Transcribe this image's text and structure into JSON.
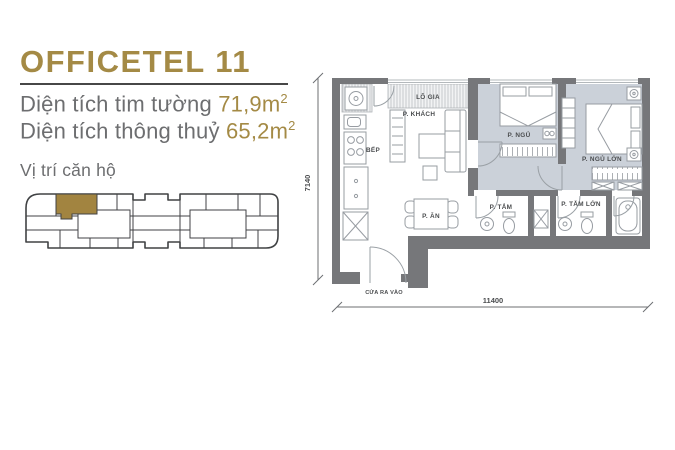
{
  "unit": {
    "title": "OFFICETEL 11",
    "areas": [
      {
        "label": "Diện tích tim tường ",
        "value": "71,9m",
        "sup": "2"
      },
      {
        "label": "Diện tích thông thuỷ ",
        "value": "65,2m",
        "sup": "2"
      }
    ],
    "location_label": "Vị trí căn hộ"
  },
  "floor_plan": {
    "rooms": {
      "loggia": "LÔ GIA",
      "living": "P. KHÁCH",
      "kitchen": "BẾP",
      "bedroom": "P. NGỦ",
      "master_bedroom": "P. NGỦ LỚN",
      "dining": "P. ĂN",
      "bathroom": "P. TẮM",
      "master_bathroom": "P. TẮM LỚN"
    },
    "entrance_label": "CỬA RA VÀO",
    "dimensions": {
      "height": "7140",
      "width": "11400"
    }
  },
  "colors": {
    "accent_gold": "#a48a45",
    "text_gray": "#6d6e70",
    "wall_gray": "#76777a",
    "room_floor": "#cbd1d9"
  }
}
